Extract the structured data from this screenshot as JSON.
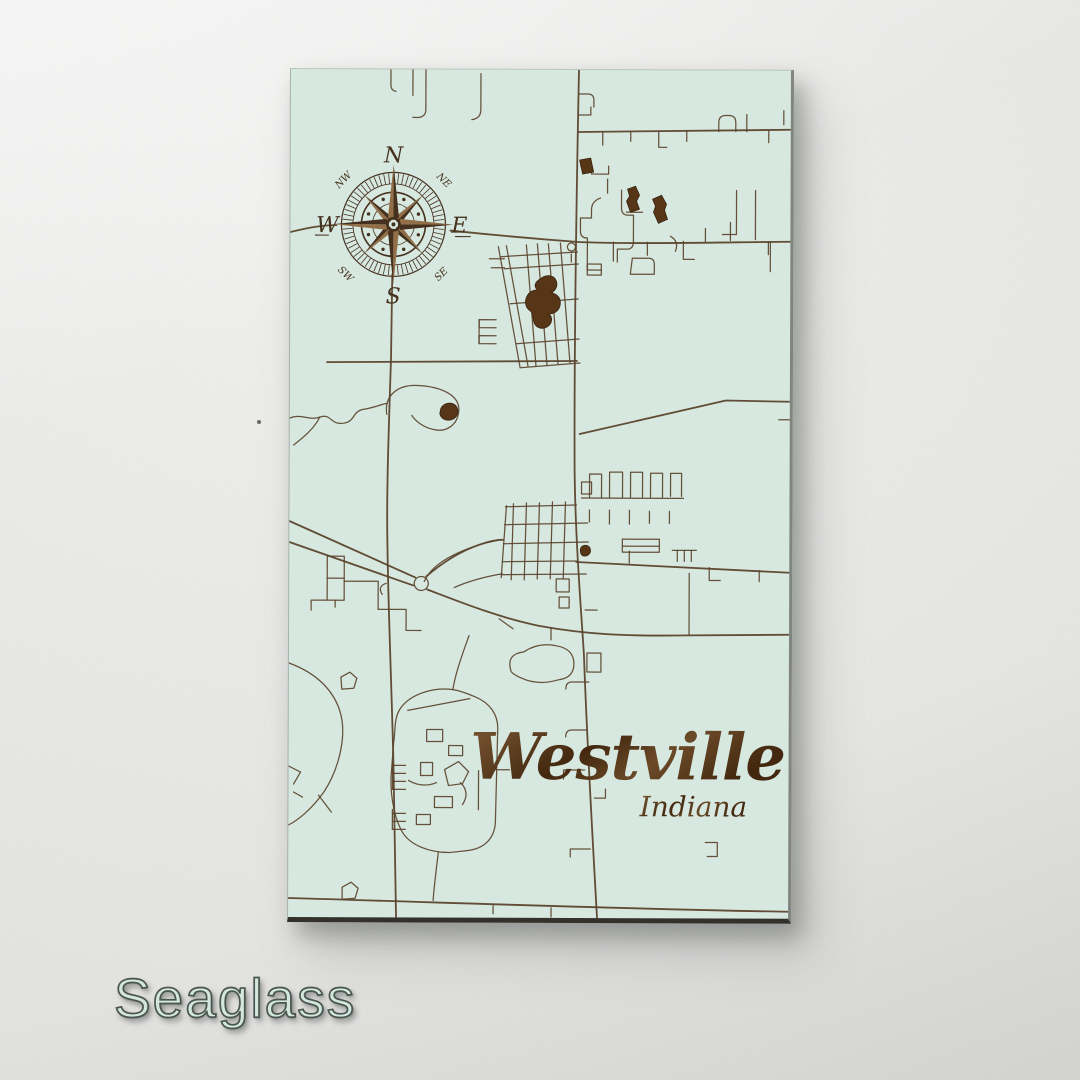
{
  "product": {
    "title": "Westville",
    "subtitle": "Indiana",
    "color_name": "Seaglass"
  },
  "compass": {
    "n": "N",
    "e": "E",
    "s": "S",
    "w": "W",
    "ne": "NE",
    "nw": "NW",
    "se": "SE",
    "sw": "SW"
  },
  "colors": {
    "panel": "#d6e8e0",
    "road": "#5b432b",
    "pond": "#573517",
    "pond_dark": "#3a2410",
    "compass_dark": "#46311f",
    "compass_light": "#926f48",
    "edge_bottom": "#34312c",
    "edge_right": "#81857f",
    "label_fill": "#d3e7df",
    "label_stroke": "#4b5550",
    "title_light": "#7d5a35",
    "title_dark": "#43280f"
  },
  "map": {
    "major_roads": [
      "M288,0 C286,120 284,260 285,400 C286,470 292,540 295,585 C298,665 304,765 309,848",
      "M0,829 C160,833 340,839 500,841",
      "M102,205 L101,290 C99,360 97,420 98,470 C99,540 103,620 105,700 C106,760 107,810 108,848",
      "M0,452 L126,508",
      "M0,473 L124,516",
      "M138,520 C170,532 210,548 250,556 C300,565 340,566 400,565 L500,564",
      "M137,507 C152,494 170,482 190,475 C201,471 208,470 214,470",
      "M0,163 C20,158 32,156 46,156",
      "M160,161 C200,165 246,169 288,172 C340,174 420,172 500,171",
      "M287,492 C340,494 420,498 500,502",
      "M290,364 L436,330 L500,331",
      "M37,293 L287,291",
      "M288,62 L500,59"
    ],
    "minor_roads": [
      "M100,0 v16 q0,5 5,6",
      "M122,0 v26",
      "M135,0 v40 q0,7 -7,8 h-6",
      "M190,4 v36 q0,9 -9,10",
      "M312,62 v13",
      "M340,62 v9",
      "M368,62 v15 h8",
      "M396,61 v10",
      "M478,60 v12",
      "M428,61 v-9 q0,-7 7,-7 h3 q7,0 7,7 v9",
      "M456,61 v-17",
      "M493,40 v14",
      "M288,24 h9 q6,0 6,6 v7",
      "M288,45 h12 v-8",
      "M290,96 h11 v8 h17 v-8",
      "M317,123 v-14",
      "M310,128 q-9,3 -9,12 v8 h-11 v13 q0,7 7,7 v32",
      "M331,120 v18 q0,7 7,7 h5 v27 q0,7 -7,7 h-9 v13",
      "M352,142 h-16",
      "M342,188 h16 q6,0 6,6 v10 h-24 z",
      "M380,166 q9,5 5,15",
      "M446,120 v44 h-14",
      "M465,120 v49",
      "M440,152 v18",
      "M480,171 v30",
      "M323,172 v19",
      "M357,172 v13",
      "M393,171 v18 h11",
      "M478,171 v13",
      "M415,171 v-13",
      "M208,177 L230,297",
      "M216,176 L238,296",
      "M236,175 L246,296",
      "M247,174 L257,295",
      "M258,174 L268,294",
      "M270,173 L280,293",
      "M210,187 L287,182",
      "M214,199 L288,194",
      "M220,234 L288,229",
      "M226,274 L289,269",
      "M230,298 L290,293",
      "M281,192 v-8",
      "M281,173 a4,4 0 1,0 0.1,0",
      "M297,194 h14 v11 h-14 z",
      "M297,200 h14",
      "M206,250 h-17 v8 h17",
      "M206,266 h-17 v8 h17",
      "M189,250 v24",
      "M199,189 h15",
      "M201,198 h13",
      "M0,349 C12,344 18,352 30,348 C42,344 40,356 54,354 C66,352 62,342 74,340 C86,338 91,335 97,334",
      "M30,348 C24,360 14,368 4,376",
      "M97,345 C94,326 108,315 128,316 C152,317 170,326 169,341 C168,356 156,363 144,360 C134,358 126,352 122,346",
      "M97,514 q-9,3 -4,11",
      "M224,434 L222,510",
      "M237,433 L235,510",
      "M250,433 L248,509",
      "M263,432 L261,509",
      "M276,432 L274,509",
      "M216,437 L287,435",
      "M215,455 L298,453",
      "M214,474 L299,472",
      "M213,492 L287,491",
      "M212,505 L297,504",
      "M217,436 L212,508",
      "M212,470 C192,473 168,482 153,492 C143,499 138,505 135,512",
      "M213,504 C196,507 178,512 165,518",
      "M267,509 h13 v13 h-13 z",
      "M270,527 h10 v11 h-10 z",
      "M298,583 h14 v19 h-14 z",
      "M296,540 h12",
      "M300,612 h-17 q-6,0 -6,7",
      "M292,412 h10 v12 h-10 z",
      "M300,428 v-24 h12 v24",
      "M320,428 v-26 h13 v26",
      "M341,427 v-25 h12 v25",
      "M361,427 v-24 h12 v24",
      "M381,426 v-23 h11 v23",
      "M292,428 h102",
      "M300,440 v12",
      "M320,440 v14",
      "M340,440 v14",
      "M360,441 v12",
      "M380,441 v12",
      "M333,469 h37 v13 h-37 z",
      "M333,476 h37",
      "M383,480 h24",
      "M388,480 v11",
      "M395,480 v11",
      "M402,480 v11",
      "M400,503 L400,564",
      "M340,493 v-12",
      "M420,497 v13 h11",
      "M470,500 v11",
      "M489,349 h11",
      "M262,558 v12",
      "M210,549 l14,10",
      "M222,601 q-5,-17 13,-19 q15,-10 33,-6 q17,3 17,18 q0,14 -16,16 q-20,6 -37,-2 q-9,-4 -10,-7 z",
      "M180,566 C173,586 167,602 164,620",
      "M164,620 C141,617 119,627 111,640 C105,650 107,661 105,673 L103,701 C101,721 105,746 113,761 C121,776 141,783 161,783 L179,781 C196,779 206,769 207,753 L209,661 C210,645 201,633 186,627 C179,624 171,621 164,620 Z",
      "M119,641 L181,629",
      "M138,660 h16 v12 h-16 z",
      "M160,676 h14 v10 h-14 z",
      "M132,693 h12 v13 h-12 z",
      "M156,700 l14,-8 10,10 -6,12 -14,2 z",
      "M146,727 h18 v11 h-18 z",
      "M128,745 h14 v10 h-14 z",
      "M120,711 q14,8 28,2",
      "M172,713 q10,10 2,22",
      "M190,701 v39",
      "M104,692 v28",
      "M104,696 h13",
      "M104,704 h13",
      "M104,712 h13",
      "M104,720 h13",
      "M104,740 v20",
      "M104,744 h13",
      "M104,752 h13",
      "M104,760 h13",
      "M150,783 C148,801 146,816 145,831",
      "M207,700 h14",
      "M0,594 C28,604 46,622 52,645 C58,668 50,700 36,722 C22,742 8,752 0,756",
      "M30,726 l13,17",
      "M0,697 l12,6 -7,12",
      "M5,723 l9,5",
      "M38,487 h17 v44 h-17 z",
      "M38,509 h17",
      "M46,531 v7",
      "M55,512 h34 v28",
      "M89,540 h28 v21 h15",
      "M38,531 h-16 v10",
      "M52,608 l9,-5 7,6 -3,10 -12,1 z",
      "M54,818 l9,-5 7,6 -3,10 -13,1 z",
      "M263,838 v9",
      "M205,836 v8",
      "M417,772 h12 v14 h-10",
      "M302,779 h-20 v8",
      "M298,660 h-15 q-6,0 -6,7",
      "M296,700 h-21 v9",
      "M306,728 h11 v-9",
      "M132,507 a7,7 0 1,0 0.1,0"
    ],
    "ponds": [
      "M289,90 l11,-2 3,14 -11,2 z",
      "M337,119 L345,116 L349,125 L346,131 L349,139 L340,142 L336,131 L339,126 Z",
      "M362,129 L371,125 L376,134 L374,140 L377,149 L368,153 L363,142 L365,136 Z",
      "M250,209 C256,204 264,205 266,211 C268,216 265,221 261,223 C268,224 271,229 270,235 C269,241 264,244 259,244 C263,248 262,254 257,257 C252,260 246,258 244,253 C242,248 244,244 240,241 C235,238 234,231 237,226 C239,222 243,220 247,220 C243,216 245,212 250,209 Z",
      "M151,339 C154,333 162,332 166,336 C170,341 168,348 162,350 C156,352 151,349 150,344 Z",
      "M292,477 C295,474 300,475 301,479 C302,483 299,486 295,486 C291,486 290,480 292,477 Z"
    ]
  }
}
